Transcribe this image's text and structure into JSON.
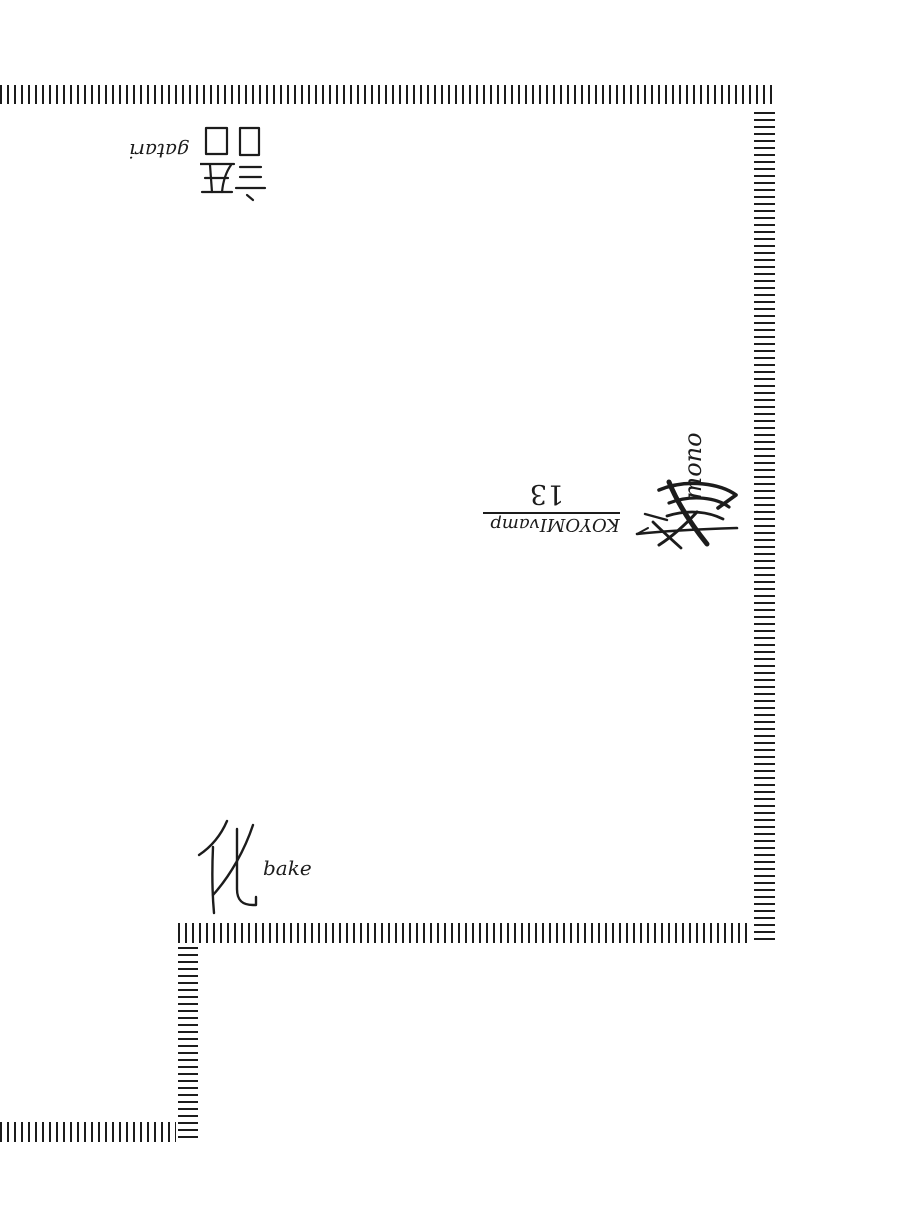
{
  "page": {
    "background": "#ffffff",
    "ink_color": "#1c1c1c"
  },
  "title": {
    "kanji_bake": "化",
    "romaji_bake": "bake",
    "kanji_mono": "物",
    "romaji_mono": "mono",
    "kanji_gatari": "語",
    "romaji_gatari": "gatari",
    "volume_number": "13",
    "series_label": "KOYOMIvamp"
  }
}
